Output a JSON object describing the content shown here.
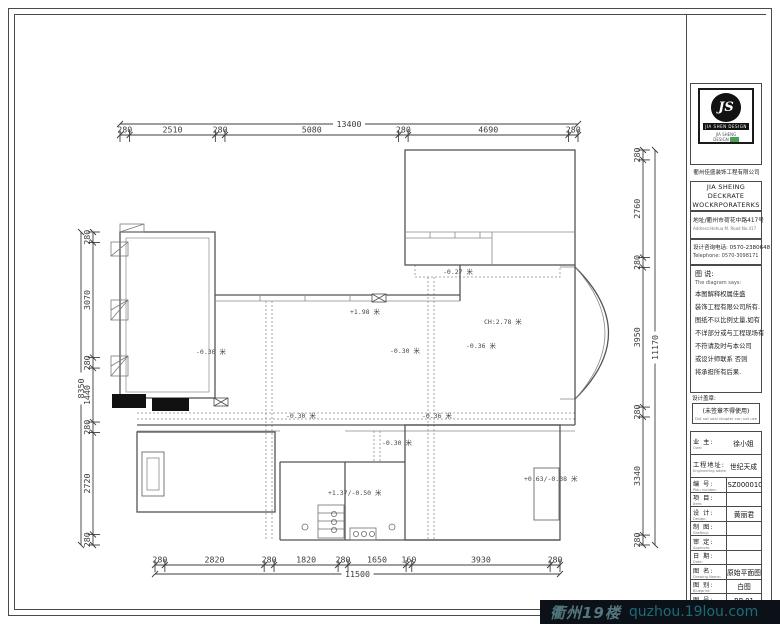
{
  "dims": {
    "top": {
      "total": "13400",
      "segments": [
        "280",
        "2510",
        "280",
        "5080",
        "280",
        "4690",
        "280"
      ]
    },
    "bottom": {
      "total": "11500",
      "segments": [
        "280",
        "2820",
        "280",
        "1820",
        "280",
        "1650",
        "160",
        "3930",
        "280"
      ]
    },
    "left": {
      "total": "8350",
      "segments": [
        "280",
        "3070",
        "280",
        "1440",
        "280",
        "2720",
        "280"
      ]
    },
    "right": {
      "total": "11170",
      "segments": [
        "280",
        "2760",
        "280",
        "3950",
        "280",
        "3340",
        "280"
      ]
    }
  },
  "elevations": [
    {
      "x": 443,
      "y": 266,
      "text": "-0.27 米"
    },
    {
      "x": 350,
      "y": 306,
      "text": "+1.98 米"
    },
    {
      "x": 484,
      "y": 316,
      "text": "CH:2.78 米"
    },
    {
      "x": 196,
      "y": 346,
      "text": "-0.30 米"
    },
    {
      "x": 390,
      "y": 345,
      "text": "-0.30 米"
    },
    {
      "x": 466,
      "y": 340,
      "text": "-0.36 米"
    },
    {
      "x": 286,
      "y": 410,
      "text": "-0.30 米"
    },
    {
      "x": 422,
      "y": 410,
      "text": "-0.36 米"
    },
    {
      "x": 382,
      "y": 437,
      "text": "-0.30 米"
    },
    {
      "x": 328,
      "y": 487,
      "text": "+1.37/-0.50 米"
    },
    {
      "x": 524,
      "y": 473,
      "text": "+0.63/-0.38 米"
    }
  ],
  "title_block": {
    "logo_monogram": "JS",
    "logo_band": "JIA SHEN DESIGN",
    "logo_sub1": "JIA SHENG",
    "logo_sub2": "DESIGN",
    "company_cn": "衢州佳盛装饰工程有限公司",
    "company_en1": "JIA SHEING DECKRATE",
    "company_en2": "WOCKRPORATERKS",
    "address_cn": "地址/衢州市荷花中路417号",
    "address_en": "Address:Hehua M. Road No.417",
    "phone_cn": "设计咨询电话: 0570-2380648",
    "phone_en": "Telephone:  0570-3098171",
    "diagram_label": "图 说:",
    "diagram_label_en": "The diagram says:",
    "diagram_lines": [
      "本图解释权属佳盛",
      "装饰工程有限公司所有.",
      "图纸不以比例丈量,如有",
      "不详部分或与工程现场有",
      "不符请及时与本公司",
      "或设计师联系 否则",
      "将承担所有后果."
    ],
    "seal_label": "设计盖章:",
    "seal_note": "(未签章不得使用)",
    "seal_note_en": "Did not seal chapter can not use",
    "rows": [
      {
        "label": "业 主:",
        "sub": "Own:",
        "value": "徐小姐"
      },
      {
        "label": "工程地址:",
        "sub": "Engineering address:",
        "value": "世纪天成"
      },
      {
        "label": "编 号:",
        "sub": "Plan number:",
        "value": "JSZ000010"
      },
      {
        "label": "项 目:",
        "sub": "Item:",
        "value": ""
      },
      {
        "label": "设 计:",
        "sub": "Design:",
        "value": "黄丽君"
      },
      {
        "label": "制 图:",
        "sub": "Drafting:",
        "value": ""
      },
      {
        "label": "审 定:",
        "sub": "Approval:",
        "value": ""
      },
      {
        "label": "日 期:",
        "sub": "Date:",
        "value": ""
      },
      {
        "label": "图 名:",
        "sub": "Drawing Name:",
        "value": "原始平面图"
      },
      {
        "label": "图 别:",
        "sub": "Blueprint:",
        "value": "白图"
      },
      {
        "label": "图 号:",
        "sub": "Drawing No:",
        "value": "BP-01"
      }
    ]
  },
  "watermark": {
    "brand": "衢州19楼",
    "url": "quzhou.19lou.com"
  }
}
